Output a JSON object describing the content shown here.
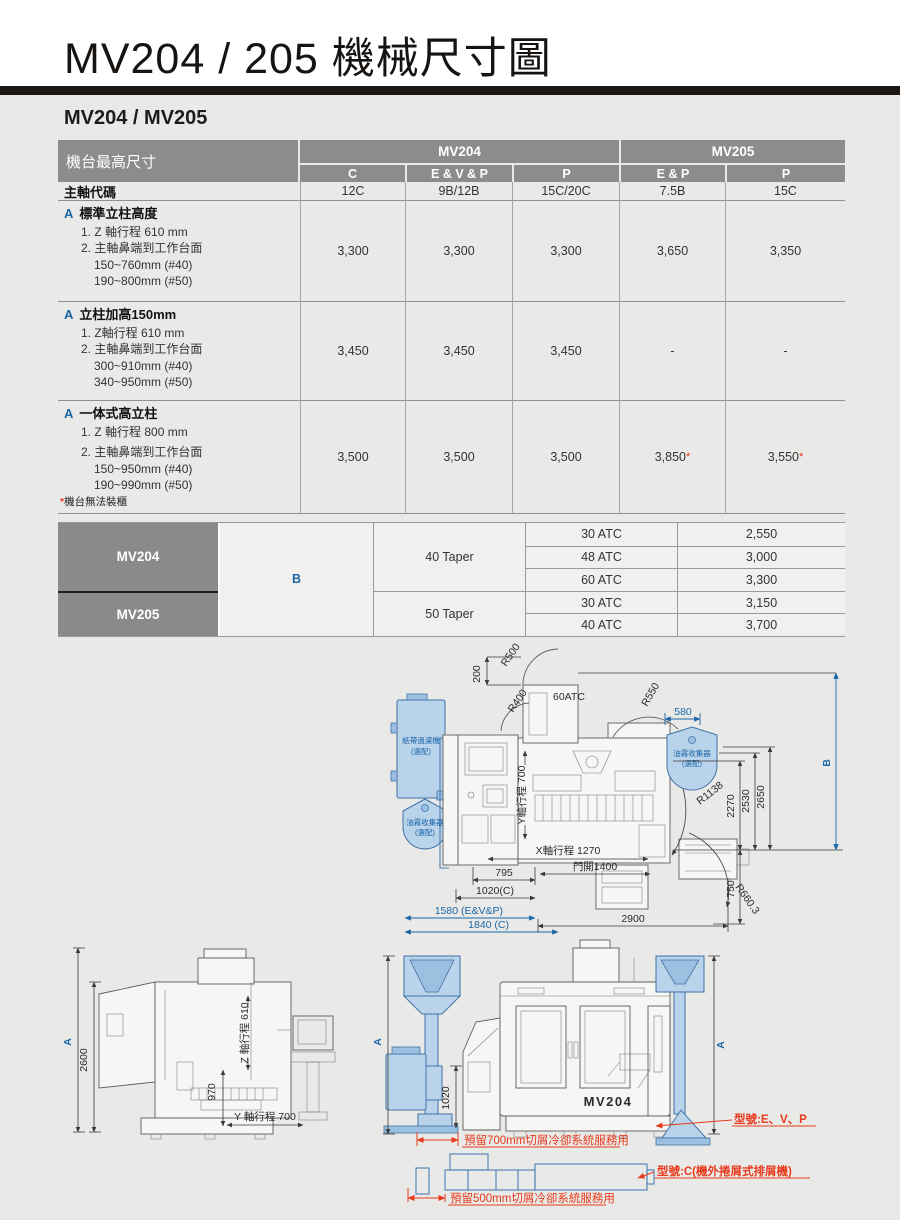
{
  "page": {
    "title": "MV204 / 205 機械尺寸圖",
    "subtitle": "MV204 / MV205"
  },
  "colors": {
    "accent_blue": "#1b66a8",
    "diagram_blue": "#4172a8",
    "diagram_blue_fill": "#b9d3ea",
    "alert_red": "#e8391d",
    "header_gray": "#8c8c8c"
  },
  "table1": {
    "corner": "機台最高尺寸",
    "group_headers": [
      "MV204",
      "MV205"
    ],
    "col_headers": [
      "C",
      "E & V & P",
      "P",
      "E & P",
      "P"
    ],
    "spindle_row": {
      "label": "主軸代碼",
      "values": [
        "12C",
        "9B/12B",
        "15C/20C",
        "7.5B",
        "15C"
      ]
    },
    "sections": [
      {
        "marker": "A",
        "title": "標準立柱高度",
        "lines": [
          "1. Z 軸行程 610 mm",
          "2. 主軸鼻端到工作台面",
          "150~760mm (#40)",
          "190~800mm (#50)"
        ],
        "values": [
          "3,300",
          "3,300",
          "3,300",
          "3,650",
          "3,350"
        ],
        "stars": [
          "",
          "",
          "",
          "",
          ""
        ]
      },
      {
        "marker": "A",
        "title": "立柱加高150mm",
        "lines": [
          "1. Z軸行程 610 mm",
          "2. 主軸鼻端到工作台面",
          "300~910mm (#40)",
          "340~950mm (#50)"
        ],
        "values": [
          "3,450",
          "3,450",
          "3,450",
          "-",
          "-"
        ],
        "stars": [
          "",
          "",
          "",
          "",
          ""
        ]
      },
      {
        "marker": "A",
        "title": "一体式高立柱",
        "lines": [
          "1. Z 軸行程 800 mm",
          "2. 主軸鼻端到工作台面",
          "150~950mm (#40)",
          "190~990mm (#50)"
        ],
        "values": [
          "3,500",
          "3,500",
          "3,500",
          "3,850",
          "3,550"
        ],
        "stars": [
          "",
          "",
          "",
          "*",
          "*"
        ]
      }
    ],
    "footnote_star": "*",
    "footnote_text": "機台無法裝櫃"
  },
  "table2": {
    "row_headers": [
      "MV204",
      "MV205"
    ],
    "b_label": "B",
    "tapers": [
      "40 Taper",
      "50 Taper"
    ],
    "rows": [
      [
        "30 ATC",
        "2,550"
      ],
      [
        "48 ATC",
        "3,000"
      ],
      [
        "60 ATC",
        "3,300"
      ],
      [
        "30 ATC",
        "3,150"
      ],
      [
        "40 ATC",
        "3,700"
      ]
    ]
  },
  "top_view": {
    "dim_200": "200",
    "r500": "R500",
    "atc": "60ATC",
    "r400": "R400",
    "r550": "R550",
    "dim_580": "580",
    "paper_filter_1": "紙帶過濾機",
    "paper_filter_2": "(選配)",
    "mist_left_1": "油霧收集器",
    "mist_left_2": "(選配)",
    "mist_right_1": "油霧收集器",
    "mist_right_2": "(選配)",
    "r1138": "R1138",
    "dim_2270": "2270",
    "dim_2530": "2530",
    "dim_2650": "2650",
    "dim_b": "B",
    "dim_750": "750",
    "y_travel": "Y軸行程 700",
    "x_travel": "X軸行程 1270",
    "dim_795": "795",
    "dim_1020c": "1020(C)",
    "dim_1580": "1580 (E&V&P)",
    "dim_1840": "1840 (C)",
    "door": "門開1400",
    "dim_2900": "2900",
    "r660": "R660.3"
  },
  "side_view": {
    "dim_a": "A",
    "dim_2600": "2600",
    "z_travel": "Z 軸行程 610",
    "dim_970": "970",
    "y_travel": "Y 軸行程 700"
  },
  "front_view": {
    "dim_a_left": "A",
    "dim_a_right": "A",
    "dim_1020": "1020",
    "machine_label": "MV204",
    "reserve_700": "預留700mm切屑冷卻系統服務用",
    "model_evp": "型號:E、V、P",
    "model_c": "型號:C(機外捲屑式排屑機)",
    "reserve_500": "預留500mm切屑冷卻系統服務用"
  }
}
